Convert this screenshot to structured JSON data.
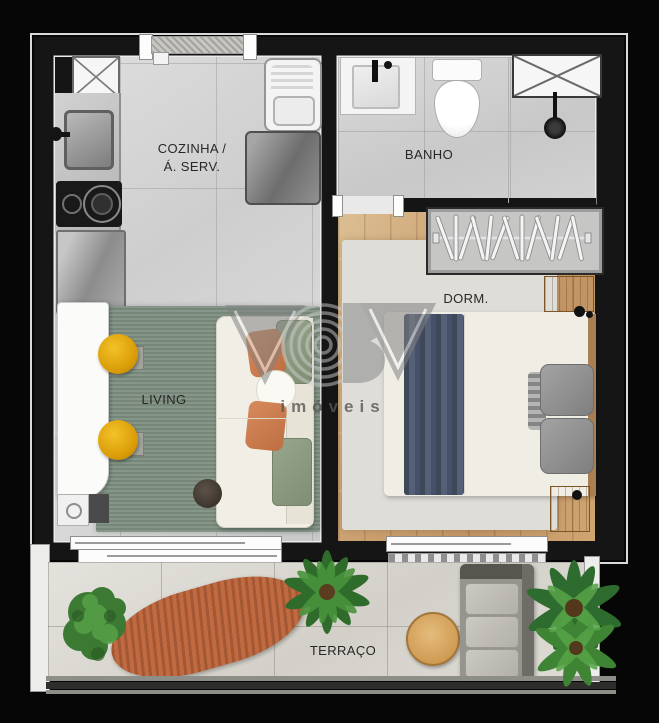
{
  "page": {
    "title": "Apartment floor plan",
    "background": "#060606"
  },
  "rooms": {
    "kitchen": {
      "label_line1": "COZINHA /",
      "label_line2": "Á. SERV."
    },
    "bathroom": {
      "label": "BANHO"
    },
    "bedroom": {
      "label": "DORM."
    },
    "living": {
      "label": "LIVING"
    },
    "terrace": {
      "label": "TERRAÇO"
    }
  },
  "watermark": {
    "brand_text": "imóveis"
  },
  "colors": {
    "wall_black": "#151515",
    "kitchen_floor": "#d4d4d4",
    "bathroom_floor": "#d0d0d0",
    "bedroom_wood": "#c9a06c",
    "bedroom_rug": "#deddd8",
    "living_rug_green": "#7d8f81",
    "terrace_floor": "#dbd9d3",
    "stool_yellow": "#e2a90e",
    "pillow_orange": "#cb7c4f",
    "cushion_green": "#8d9c83",
    "blanket_blue": "#4a5469",
    "hammock_orange": "#c1693f",
    "plant_green": "#4a8a3c",
    "watermark_gray": "#828282"
  }
}
